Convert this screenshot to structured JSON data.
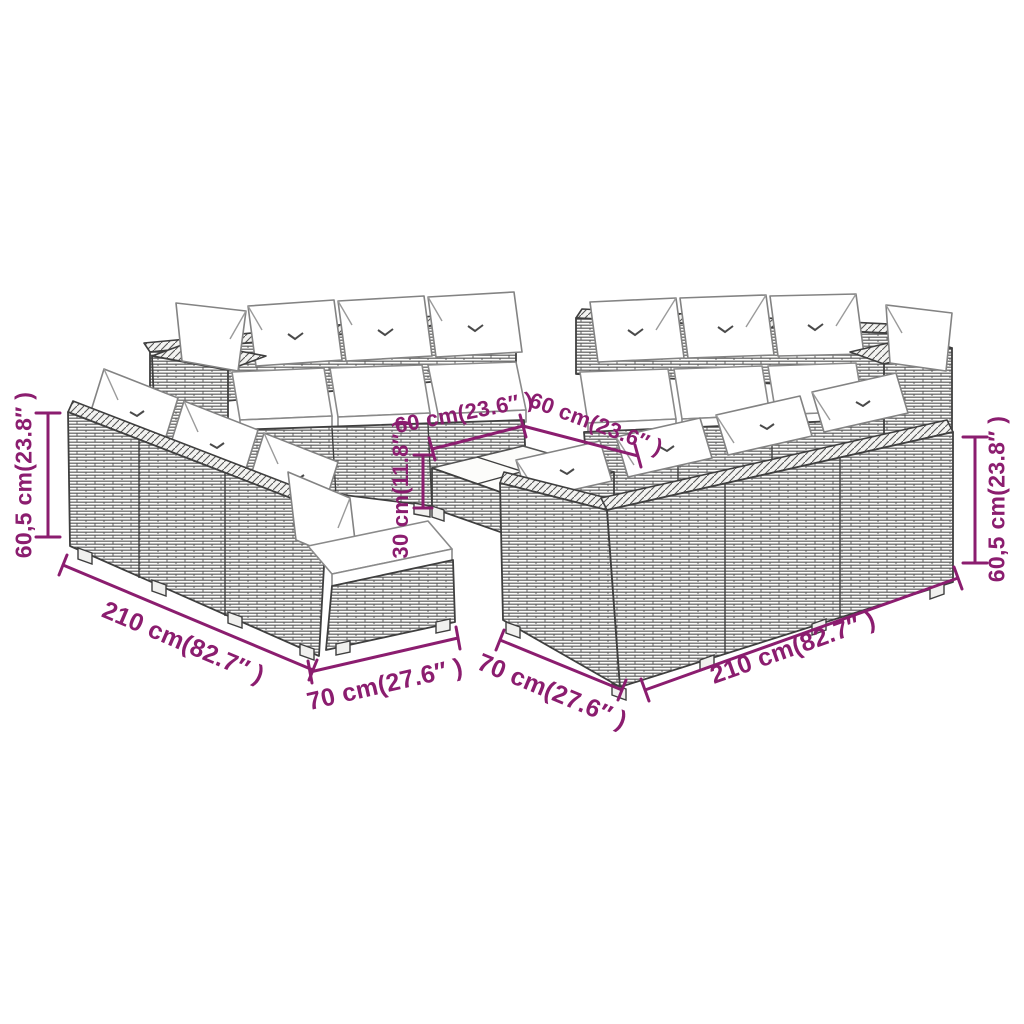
{
  "figure": {
    "subject": "modular poly rattan garden lounge set with white cushions and square coffee table",
    "style": "line-art product dimension diagram"
  },
  "colors": {
    "dimension_annotation": "#8b1d6f",
    "line_art": "#3f3f3f",
    "background": "#ffffff",
    "cushion": "#ffffff"
  },
  "dimensions": {
    "left_height": "60,5 cm(23.8″ )",
    "right_height": "60,5 cm(23.8″ )",
    "bottom_left_length": "210 cm(82.7″ )",
    "bottom_left_depth": "70 cm(27.6″ )",
    "bottom_center_depth": "70 cm(27.6″ )",
    "bottom_right_length": "210 cm(82.7″ )",
    "table_edge_left": "60 cm(23.6″ )",
    "table_edge_right": "60 cm(23.6″ )",
    "table_height": "30 cm(11.8″ )"
  }
}
